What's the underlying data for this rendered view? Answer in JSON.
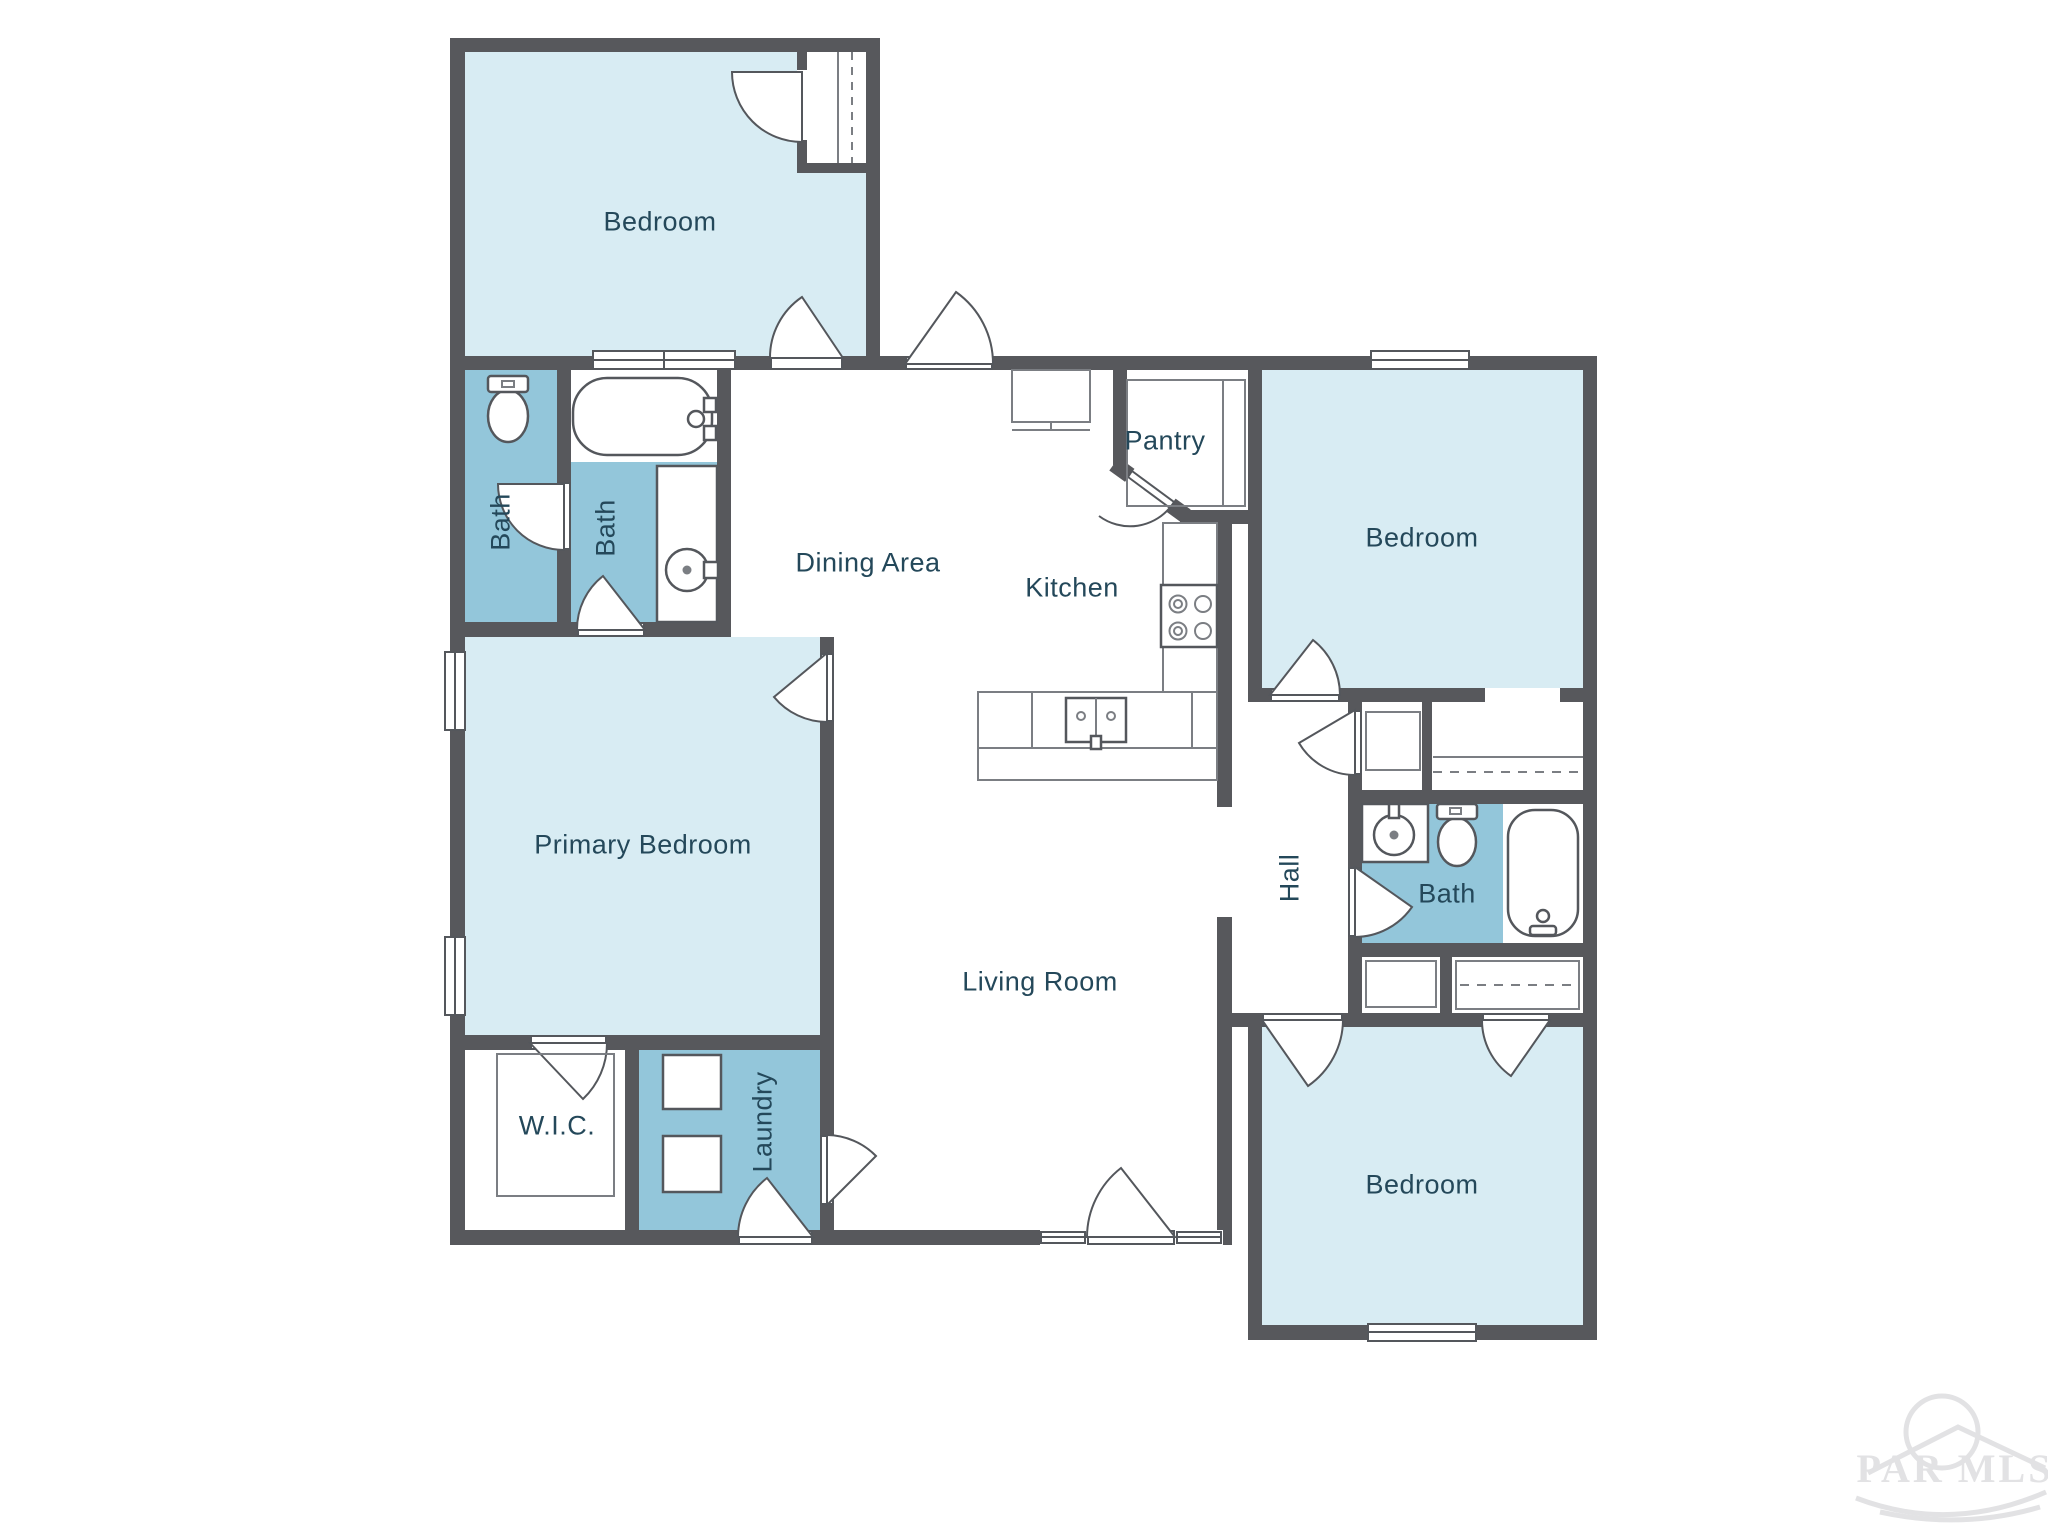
{
  "colors": {
    "wall": "#57585c",
    "room_light": "#d8ecf3",
    "room_accent": "#93c6da",
    "label": "#24485a",
    "line": "#54575c",
    "line_thin": "#7b7e83",
    "watermark": "#e2e2e4"
  },
  "rooms": {
    "bedroom_top_left": {
      "label": "Bedroom"
    },
    "bath_1": {
      "label": "Bath"
    },
    "bath_2": {
      "label": "Bath"
    },
    "dining": {
      "label": "Dining Area"
    },
    "kitchen": {
      "label": "Kitchen"
    },
    "pantry": {
      "label": "Pantry"
    },
    "bedroom_top_right": {
      "label": "Bedroom"
    },
    "hall": {
      "label": "Hall"
    },
    "bath_3": {
      "label": "Bath"
    },
    "primary_bedroom": {
      "label": "Primary Bedroom"
    },
    "wic": {
      "label": "W.I.C."
    },
    "laundry": {
      "label": "Laundry"
    },
    "living_room": {
      "label": "Living Room"
    },
    "bedroom_bottom_right": {
      "label": "Bedroom"
    }
  },
  "watermark": {
    "text": "PAR MLS"
  }
}
